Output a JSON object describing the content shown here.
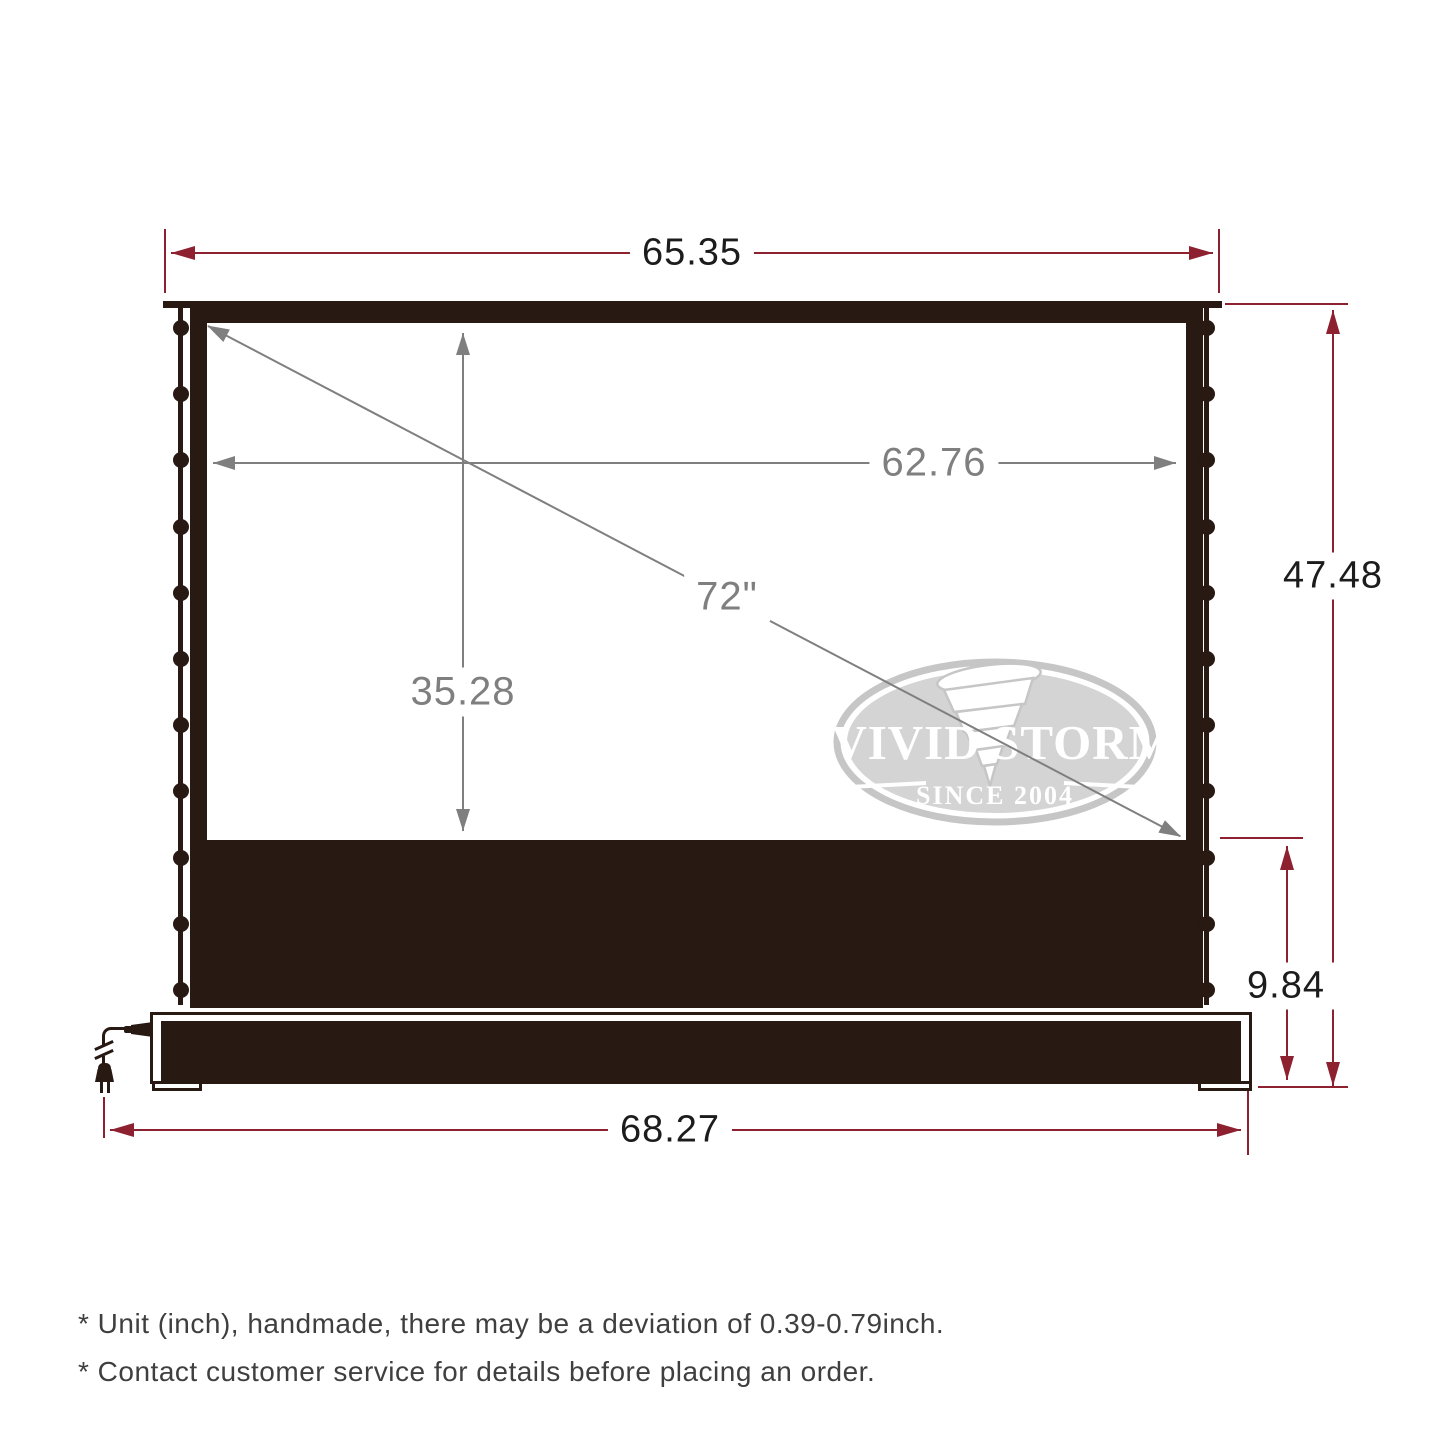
{
  "colors": {
    "frame": "#281913",
    "dimension_red": "#8e2130",
    "dimension_gray": "#7f7f7f",
    "label_ink": "#1c1c1c",
    "logo_gray": "#c6c6c6",
    "note_text": "#3f3f3f"
  },
  "dimensions": {
    "top_width": {
      "value": "65.35"
    },
    "viewable_width": {
      "value": "62.76"
    },
    "diagonal": {
      "value": "72\""
    },
    "viewable_height": {
      "value": "35.28"
    },
    "total_height": {
      "value": "47.48"
    },
    "riser_height": {
      "value": "9.84"
    },
    "base_width": {
      "value": "68.27"
    }
  },
  "logo": {
    "brand_left": "VIVID",
    "brand_right": "STORM",
    "tagline": "SINCE 2004"
  },
  "screen": {
    "tab_count_per_side": 11
  },
  "notes": [
    "* Unit (inch), handmade, there may be a deviation of 0.39-0.79inch.",
    "* Contact customer service for details before placing an order."
  ]
}
